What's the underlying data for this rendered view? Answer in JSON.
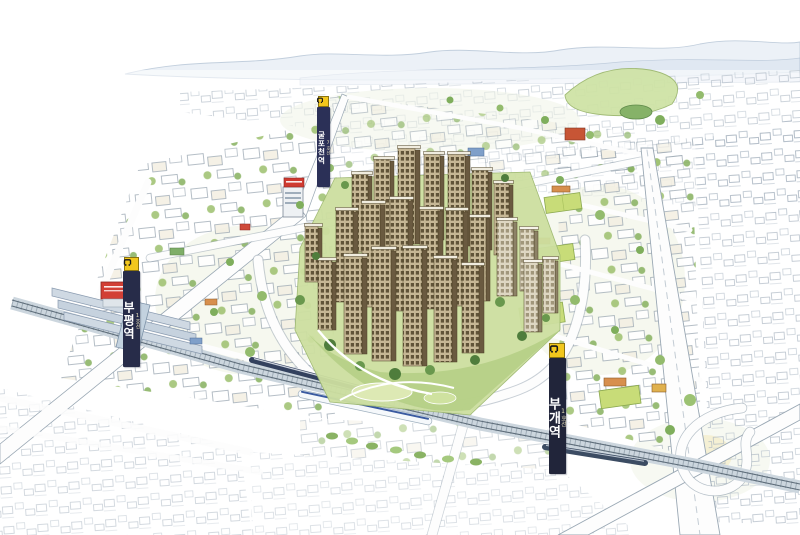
{
  "scene": {
    "description": "Hand-drawn watercolor bird's-eye illustration of a high-rise apartment complex district: central sepia tower cluster with parks, surrounded by a sketched city grid, railway with trains, schools with green fields, a highway loop interchange at lower right and faint mountains on the horizon"
  },
  "signs": {
    "station_west": {
      "line": "1호선",
      "name": "부평역",
      "icon": "subway-logo"
    },
    "station_east": {
      "line": "1호선",
      "name": "부개역",
      "icon": "subway-logo"
    },
    "station_north": {
      "line": "7호선",
      "name": "굴포천역",
      "icon": "subway-logo"
    }
  },
  "colors": {
    "sign_navy": "#272c49",
    "sign_yellow": "#f2c71d",
    "tower_tan": "#c6b795",
    "tower_window": "#57492f",
    "tower_side": "#6a5a40",
    "park_green": "#cddfa0",
    "field_green": "#c8dc78",
    "tree_green": "#7fae5c",
    "road_outline": "#9aa8b4",
    "rail_gray": "#5e6d7a",
    "train_navy": "#33415e",
    "train_stripe_blue": "#3a5aa0",
    "billboard_red": "#d23f35",
    "roof_orange": "#d78f4d",
    "mountain_blue": "#aebfd2",
    "sketch_gray": "#a8b4c0"
  }
}
